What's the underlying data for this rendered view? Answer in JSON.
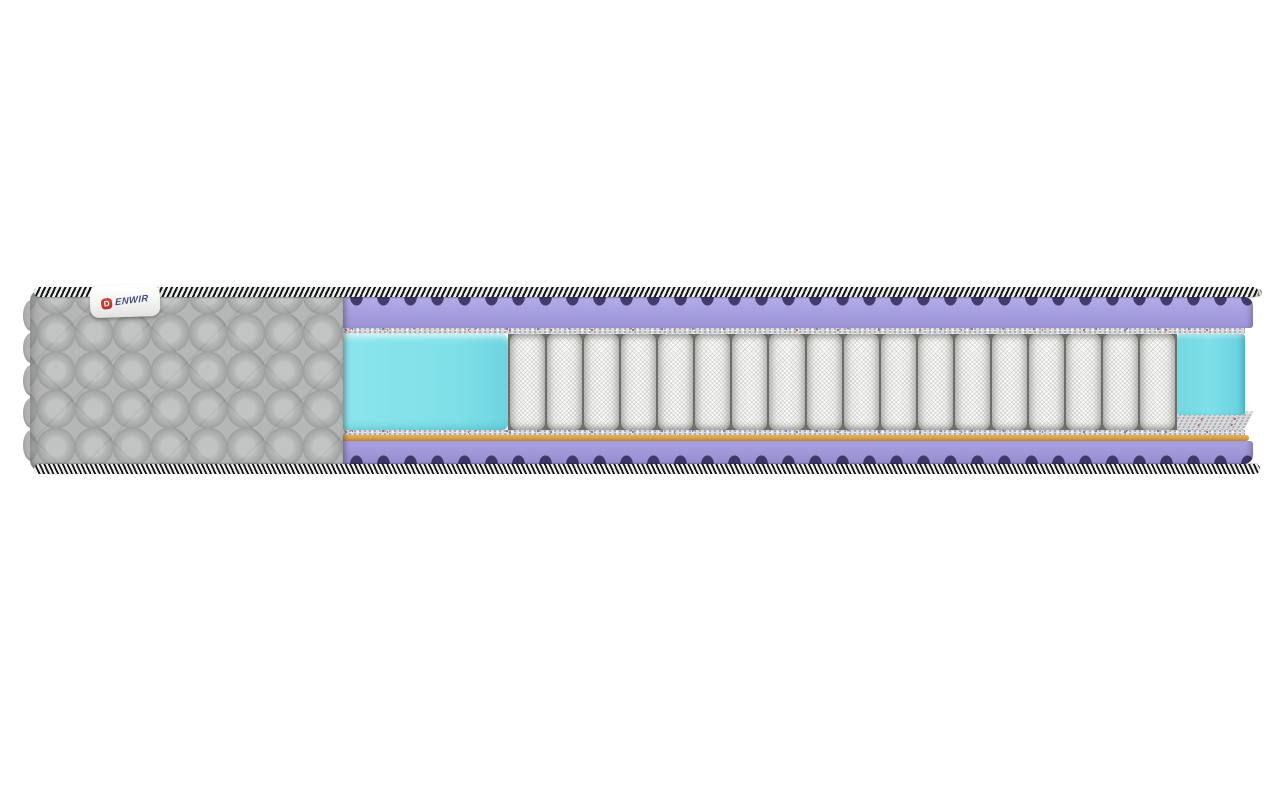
{
  "image_type": "product-photo",
  "subject": "mattress-cutaway-cross-section",
  "label": {
    "brand_mark": "D",
    "brand_text": "ENWIR"
  },
  "mattress": {
    "cover": {
      "quilt_rows": 5,
      "quilt_cols": 8,
      "scallop_count": 5
    },
    "core": {
      "spring_count": 18
    },
    "layers": [
      {
        "name": "border-braid-top",
        "color_ref": "braid_dark"
      },
      {
        "name": "wave-foam-top",
        "color_ref": "purple"
      },
      {
        "name": "felt-pad-top",
        "color_ref": "felt"
      },
      {
        "name": "edge-support-foam-left",
        "color_ref": "cyan"
      },
      {
        "name": "pocket-spring-block",
        "color_ref": "spring_light"
      },
      {
        "name": "edge-support-foam-right",
        "color_ref": "cyan"
      },
      {
        "name": "felt-pad-bottom",
        "color_ref": "felt"
      },
      {
        "name": "coir-layer",
        "color_ref": "coir"
      },
      {
        "name": "wave-foam-bottom",
        "color_ref": "purple"
      },
      {
        "name": "border-braid-bottom",
        "color_ref": "braid_dark"
      }
    ]
  },
  "colors": {
    "cover_gray": "#b5b6b6",
    "braid_dark": "#141414",
    "braid_light": "#ececec",
    "purple": "#a8a1e0",
    "purple_dark": "#433c6a",
    "purple_dark2": "#3e3866",
    "felt": "#d8d8d6",
    "felt_speck": "#9a9ab2",
    "felt_speck_red": "#c25555",
    "felt_speck_blue": "#6470b8",
    "coir": "#d8a24b",
    "coir_dark": "#b78437",
    "cyan": "#7edfe8",
    "spring_light": "#f5f5f3",
    "spring_dark": "#c6c6c4",
    "spring_gap": "#6e6e68",
    "label_red": "#d93a30",
    "label_text": "#41517a",
    "rope_a": "#7c7c7c",
    "rope_b": "#dddddd",
    "background": "#ffffff"
  }
}
